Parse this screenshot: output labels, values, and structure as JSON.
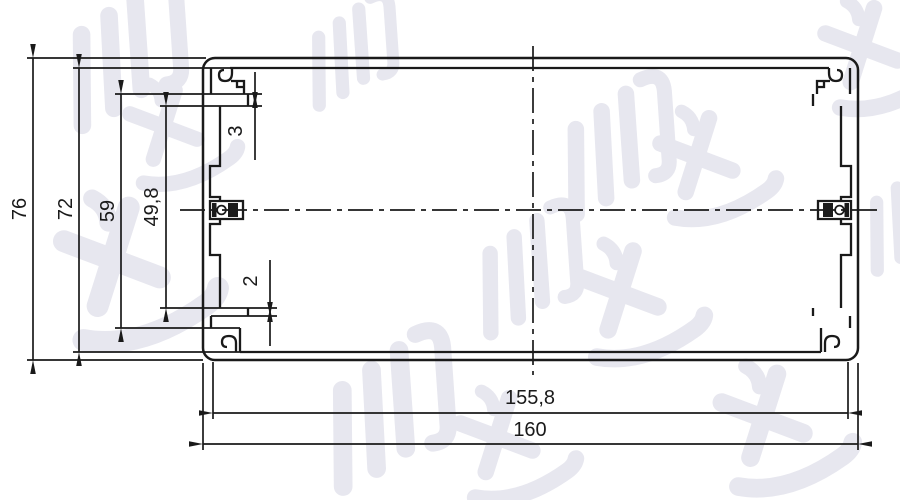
{
  "drawing": {
    "dims": {
      "overall_height": "76",
      "inner_height": "72",
      "rail_outer_span": "59",
      "rail_inner_span": "49,8",
      "top_rail_thickness": "3",
      "bottom_rail_thickness": "2",
      "inner_width": "155,8",
      "overall_width": "160"
    }
  },
  "watermark": {
    "text": "鸿发顺达"
  },
  "colors": {
    "line": "#1a1a1a",
    "watermark": "#e7e7ef",
    "background": "#ffffff"
  }
}
